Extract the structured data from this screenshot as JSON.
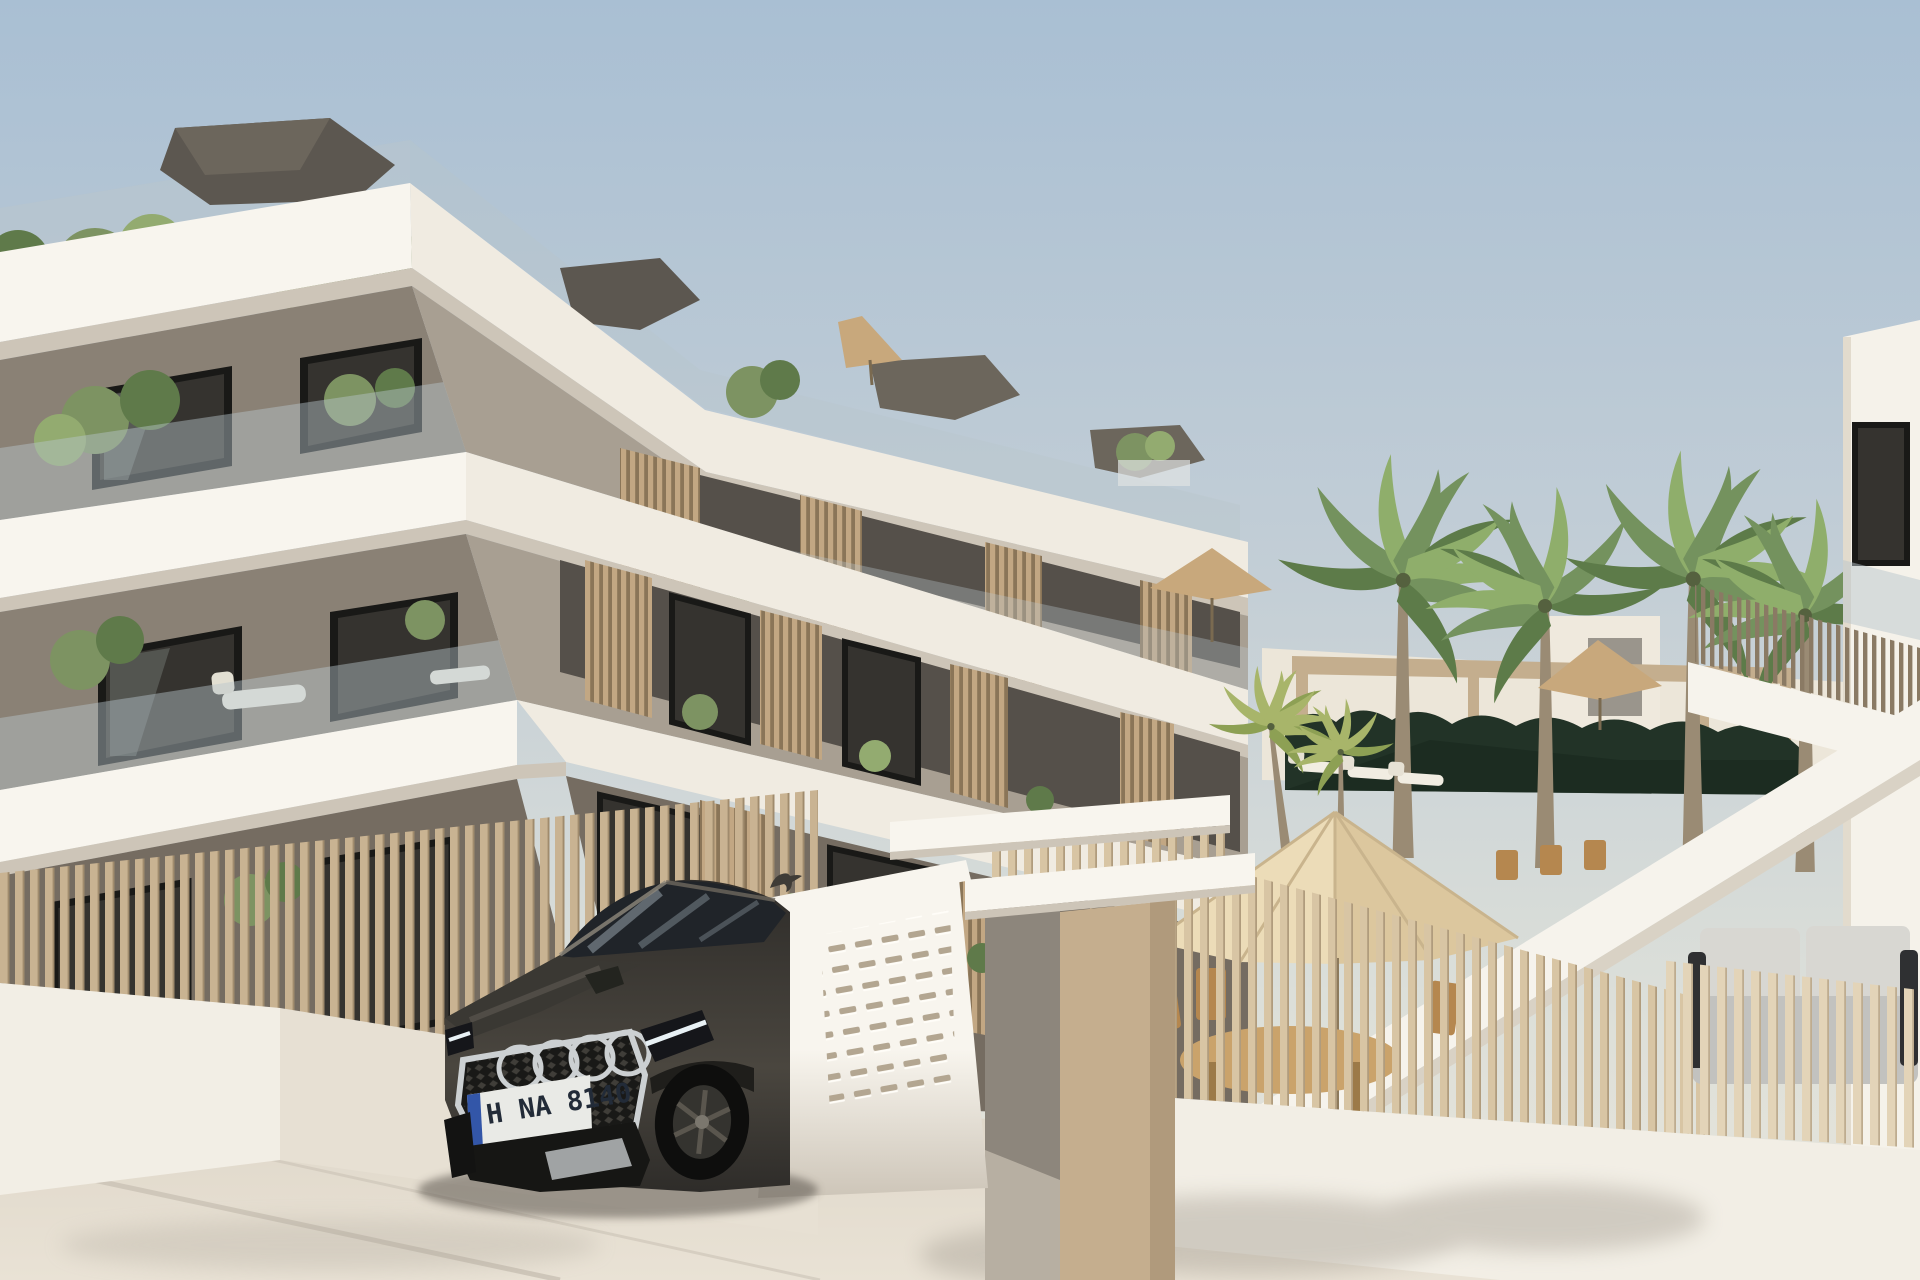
{
  "scene": {
    "type": "architectural-render",
    "license_plate": {
      "text": "H NA 8140"
    }
  },
  "colors": {
    "sky-top": "#a9bfd3",
    "sky-mid": "#c3ced6",
    "sky-low": "#dcdfd9",
    "sky-horizon": "#e9e5da",
    "white-sun": "#f8f5ee",
    "white-shade": "#f0ebe1",
    "white-soffit": "#cdc5b8",
    "wall-left": "#8a8175",
    "wall-left-dark": "#756c61",
    "wall-right": "#a89f92",
    "recess": "#55504a",
    "recess-dark": "#3f3b36",
    "glass-rail": "#b9c6cb",
    "window-dark": "#35332f",
    "window-frame": "#191917",
    "window-refl": "#8d948f",
    "roof-dark": "#5c5750",
    "roof-dark2": "#6c665c",
    "green-a": "#7d9362",
    "green-b": "#5f7a4a",
    "green-c": "#93ab70",
    "palm-a": "#74925e",
    "palm-b": "#5d7b49",
    "palm-c": "#8fae6b",
    "palm-small-a": "#a8b56a",
    "palm-small-b": "#8da054",
    "palm-trunk": "#9a8b74",
    "fence-slat": "#c9b392",
    "fence-slat-edge": "#a08b6d",
    "fence-patio": "#d8c5a4",
    "fence-sofa": "#e3d4b8",
    "fence-upper": "#8a7a64",
    "screen-bg": "#8a7558",
    "screen-bar": "#c2a783",
    "wall-low": "#f2eee5",
    "wall-low-shade": "#e7e0d3",
    "pillar-tan": "#c5ae8e",
    "pillar-tan-shade": "#b09a7c",
    "walkway": "#8d867c",
    "walkway-floor": "#b7afa2",
    "slot-dark": "#b3a691",
    "slot-bevel": "#fffdf8",
    "hedge": "#223327",
    "hedge-dark": "#1a2a20",
    "pergola": "#c4ae8e",
    "far-wall": "#ece6d9",
    "tower-wall": "#efe9dd",
    "tower-win": "#9a958c",
    "umbrella-light": "#ecdcb8",
    "umbrella-dark": "#dcc79e",
    "umbrella-rib": "#c9b48d",
    "parasol": "#c8a87c",
    "table-wood": "#caa36b",
    "chair-wood": "#b5874f",
    "sofa-base": "#c2c2bf",
    "sofa-cushion": "#d8d7d2",
    "sofa-dark": "#2f3032",
    "stairs-white": "#f6f3ec",
    "stairs-shade": "#d9d2c5",
    "step-line": "#b5ad9f",
    "pave-near": "#e9e2d5",
    "pave-far": "#d9d1c3",
    "curb": "#cfc7ba",
    "shadow": "#a9a296",
    "car-body": "#2e2c29",
    "car-body-light": "#4a463f",
    "car-hood": "#3a3833",
    "car-glass": "#202429",
    "car-glass-refl": "#aebcc4",
    "chrome": "#ccd0d2",
    "car-dark": "#161614",
    "drl": "#e8f1f5",
    "plate-white": "#e9eae6",
    "plate-blue": "#3356a8",
    "plate-text": "#222b38",
    "tire": "#0e0e0d",
    "rim": "#34332f",
    "spoke": "#5a564e",
    "bird": "#3f3c37",
    "right-wall": "#f5f2ea",
    "right-wall-shade": "#e2dbcd"
  }
}
